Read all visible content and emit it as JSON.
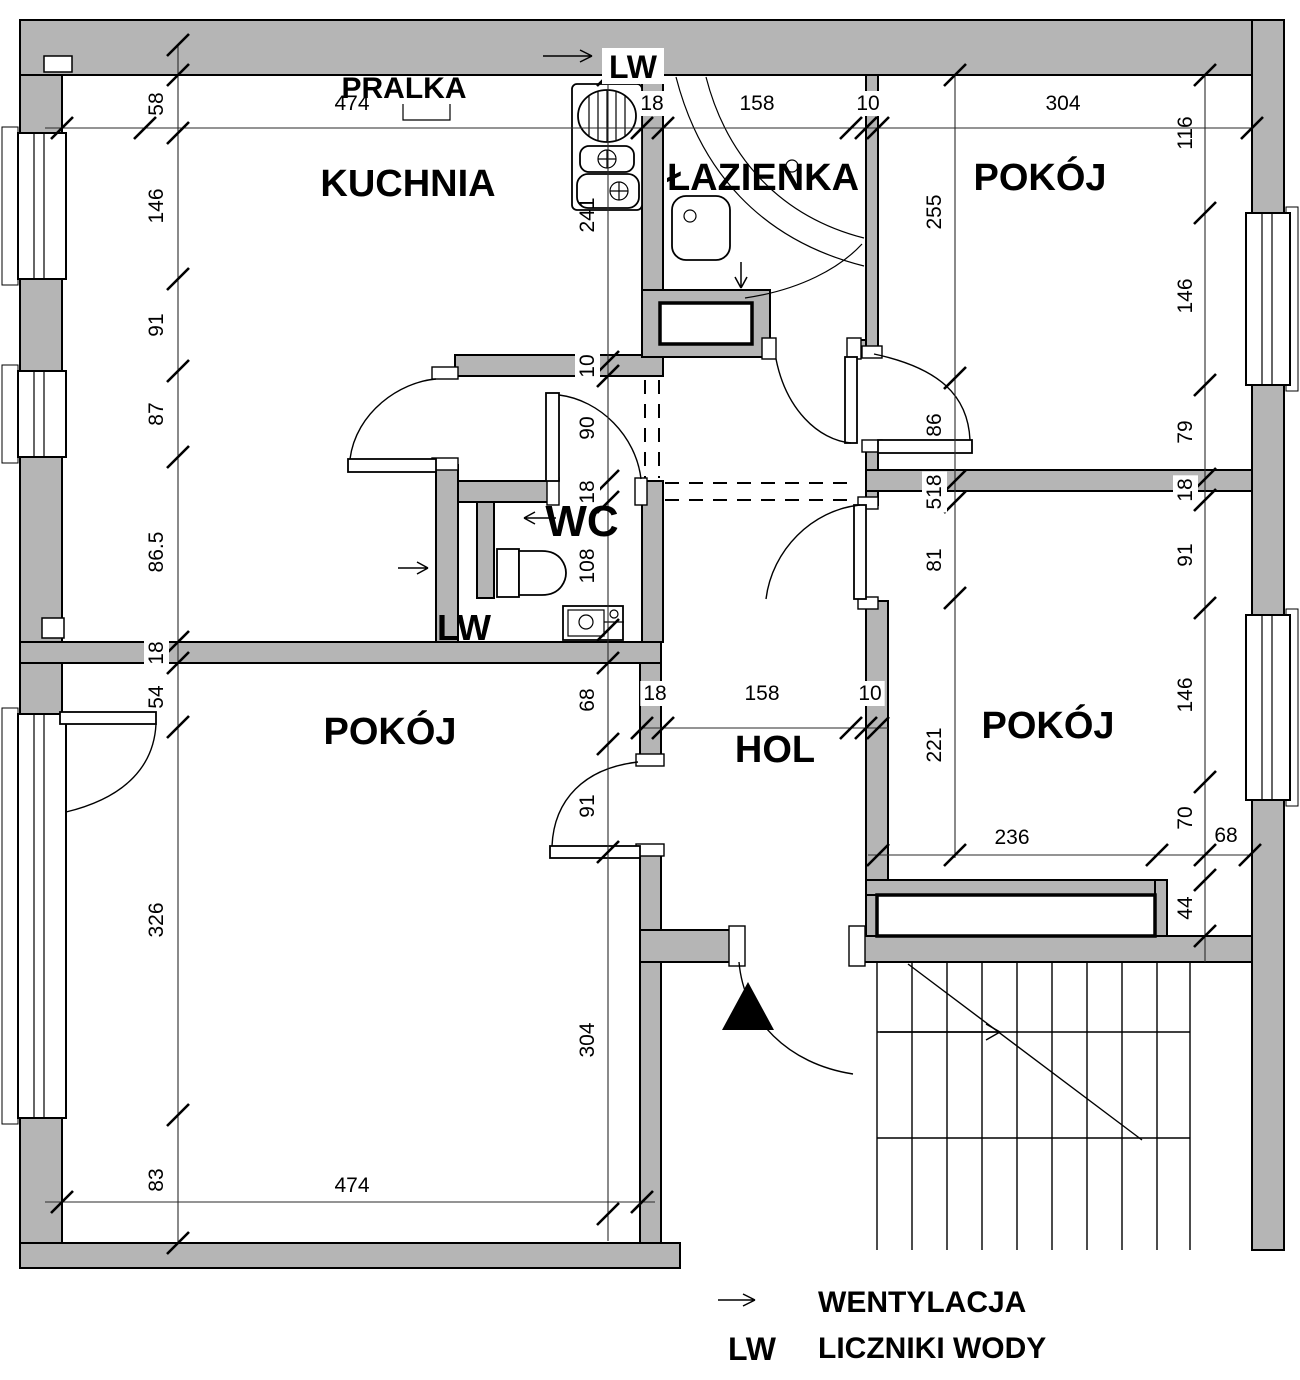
{
  "colors": {
    "wall_fill": "#b5b5b5",
    "line": "#000000",
    "background": "#ffffff"
  },
  "rooms": [
    {
      "id": "kuchnia",
      "label": "KUCHNIA",
      "x": 408,
      "y": 196,
      "fs": 38
    },
    {
      "id": "lazienka",
      "label": "ŁAZIENKA",
      "x": 763,
      "y": 190,
      "fs": 38
    },
    {
      "id": "pokoj-top-right",
      "label": "POKÓJ",
      "x": 1040,
      "y": 190,
      "fs": 38
    },
    {
      "id": "pokoj-bottom-left",
      "label": "POKÓJ",
      "x": 390,
      "y": 744,
      "fs": 38
    },
    {
      "id": "hol",
      "label": "HOL",
      "x": 775,
      "y": 762,
      "fs": 38
    },
    {
      "id": "pokoj-bottom-right",
      "label": "POKÓJ",
      "x": 1048,
      "y": 738,
      "fs": 38
    },
    {
      "id": "wc",
      "label": "WC",
      "x": 582,
      "y": 536,
      "fs": 44
    },
    {
      "id": "pralka",
      "label": "PRALKA",
      "x": 404,
      "y": 98,
      "fs": 30
    },
    {
      "id": "lw-top",
      "label": "LW",
      "x": 633,
      "y": 78,
      "fs": 32
    },
    {
      "id": "lw-wc",
      "label": "LW",
      "x": 464,
      "y": 640,
      "fs": 36
    }
  ],
  "dimensions": [
    {
      "t": "58",
      "x": 163,
      "y": 104,
      "r": 1
    },
    {
      "t": "146",
      "x": 163,
      "y": 206,
      "r": 1
    },
    {
      "t": "91",
      "x": 163,
      "y": 325,
      "r": 1
    },
    {
      "t": "87",
      "x": 163,
      "y": 414,
      "r": 1
    },
    {
      "t": "86.5",
      "x": 163,
      "y": 552,
      "r": 1
    },
    {
      "t": "18",
      "x": 163,
      "y": 653,
      "r": 1,
      "bg": 1
    },
    {
      "t": "54",
      "x": 163,
      "y": 697,
      "r": 1
    },
    {
      "t": "326",
      "x": 163,
      "y": 920,
      "r": 1
    },
    {
      "t": "83",
      "x": 163,
      "y": 1180,
      "r": 1
    },
    {
      "t": "474",
      "x": 352,
      "y": 110
    },
    {
      "t": "18",
      "x": 652,
      "y": 110,
      "bg": 1
    },
    {
      "t": "158",
      "x": 757,
      "y": 110
    },
    {
      "t": "10",
      "x": 868,
      "y": 110,
      "bg": 1
    },
    {
      "t": "304",
      "x": 1063,
      "y": 110
    },
    {
      "t": "241",
      "x": 594,
      "y": 215,
      "r": 1
    },
    {
      "t": "10",
      "x": 594,
      "y": 366,
      "r": 1,
      "bg": 1
    },
    {
      "t": "90",
      "x": 594,
      "y": 428,
      "r": 1
    },
    {
      "t": "18",
      "x": 594,
      "y": 492,
      "r": 1,
      "bg": 1
    },
    {
      "t": "108",
      "x": 594,
      "y": 566,
      "r": 1
    },
    {
      "t": "68",
      "x": 594,
      "y": 700,
      "r": 1
    },
    {
      "t": "91",
      "x": 594,
      "y": 806,
      "r": 1
    },
    {
      "t": "304",
      "x": 594,
      "y": 1040,
      "r": 1
    },
    {
      "t": "255",
      "x": 941,
      "y": 212,
      "r": 1
    },
    {
      "t": "86",
      "x": 941,
      "y": 425,
      "r": 1
    },
    {
      "t": "518",
      "x": 941,
      "y": 492,
      "r": 1,
      "bg": 1
    },
    {
      "t": "81",
      "x": 941,
      "y": 560,
      "r": 1
    },
    {
      "t": "221",
      "x": 941,
      "y": 745,
      "r": 1
    },
    {
      "t": "116",
      "x": 1192,
      "y": 133,
      "r": 1
    },
    {
      "t": "146",
      "x": 1192,
      "y": 296,
      "r": 1
    },
    {
      "t": "79",
      "x": 1192,
      "y": 432,
      "r": 1
    },
    {
      "t": "18",
      "x": 1192,
      "y": 490,
      "r": 1,
      "bg": 1
    },
    {
      "t": "91",
      "x": 1192,
      "y": 555,
      "r": 1
    },
    {
      "t": "146",
      "x": 1192,
      "y": 695,
      "r": 1
    },
    {
      "t": "70",
      "x": 1192,
      "y": 818,
      "r": 1
    },
    {
      "t": "68",
      "x": 1226,
      "y": 842
    },
    {
      "t": "44",
      "x": 1192,
      "y": 908,
      "r": 1
    },
    {
      "t": "236",
      "x": 1012,
      "y": 844
    },
    {
      "t": "18",
      "x": 655,
      "y": 700,
      "bg": 1
    },
    {
      "t": "158",
      "x": 762,
      "y": 700
    },
    {
      "t": "10",
      "x": 870,
      "y": 700,
      "bg": 1
    },
    {
      "t": "474",
      "x": 352,
      "y": 1192
    }
  ],
  "legend": {
    "ventilation_label": "WENTYLACJA",
    "lw_abbr": "LW",
    "lw_label": "LICZNIKI WODY"
  }
}
